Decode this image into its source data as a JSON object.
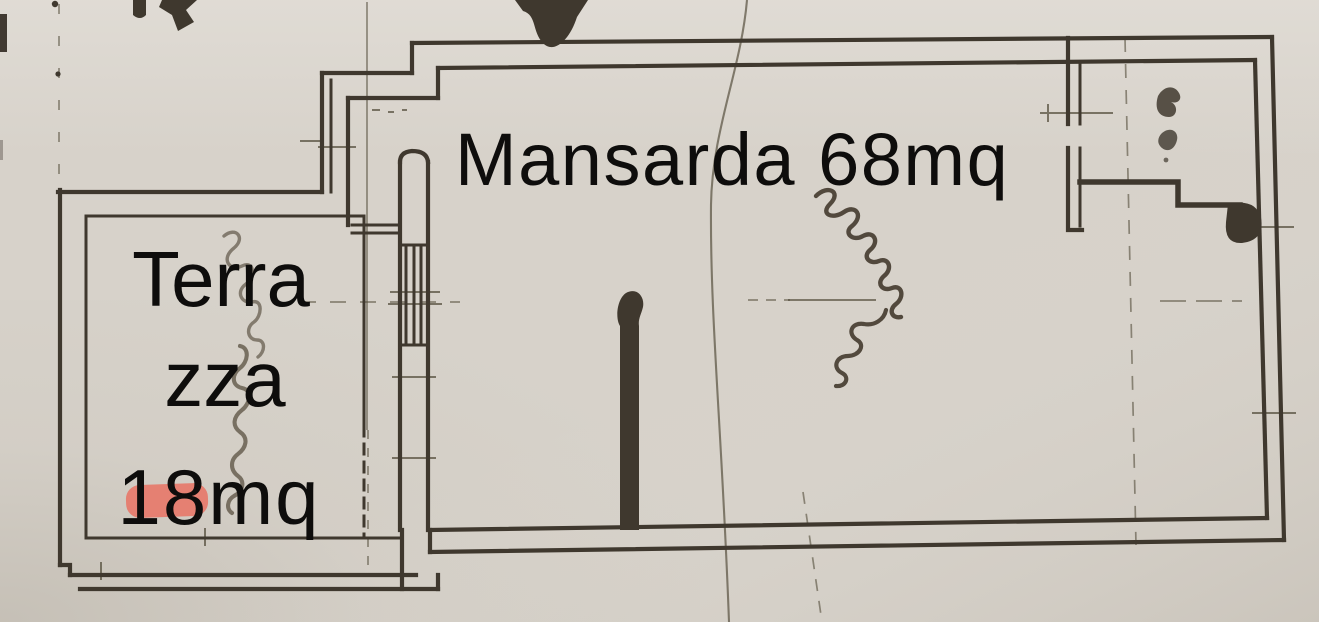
{
  "document": {
    "kind": "Scanned cadastral floor plan of an attic apartment with terrace",
    "language": "Italian"
  },
  "colors": {
    "paper": "#d7d2ca",
    "paper-light": "#e4e0da",
    "paper-shade": "#b7b0a5",
    "ink": "#3f382e",
    "thin-line": "#57503f",
    "pencil": "#6e6557",
    "label": "#0e0d0c",
    "highlight": "#ea6a5b"
  },
  "rooms": {
    "mansarda": {
      "name": "Mansarda",
      "area": "68mq",
      "label": "Mansarda 68mq"
    },
    "terrazza": {
      "name": "Terrazza",
      "area": "18mq",
      "label_lines": [
        "Terra",
        "zza",
        "18mq"
      ]
    },
    "wc": {
      "note": "small room at top-right bearing a tiny illegible handwritten mark"
    }
  },
  "handwriting": {
    "terrazza_script": "vertical cursive pencil scrawl over terrace (illegible)",
    "mansarda_script": "slanted cursive ink scrawl in room centre (illegible)",
    "wc_script": "small ink scrawl inside top-right room (illegible)"
  },
  "marks": {
    "red_highlight": "pink marker stroke under the number 18",
    "top_edge": "cut-off dark pen marks along the top edge of the scan"
  }
}
